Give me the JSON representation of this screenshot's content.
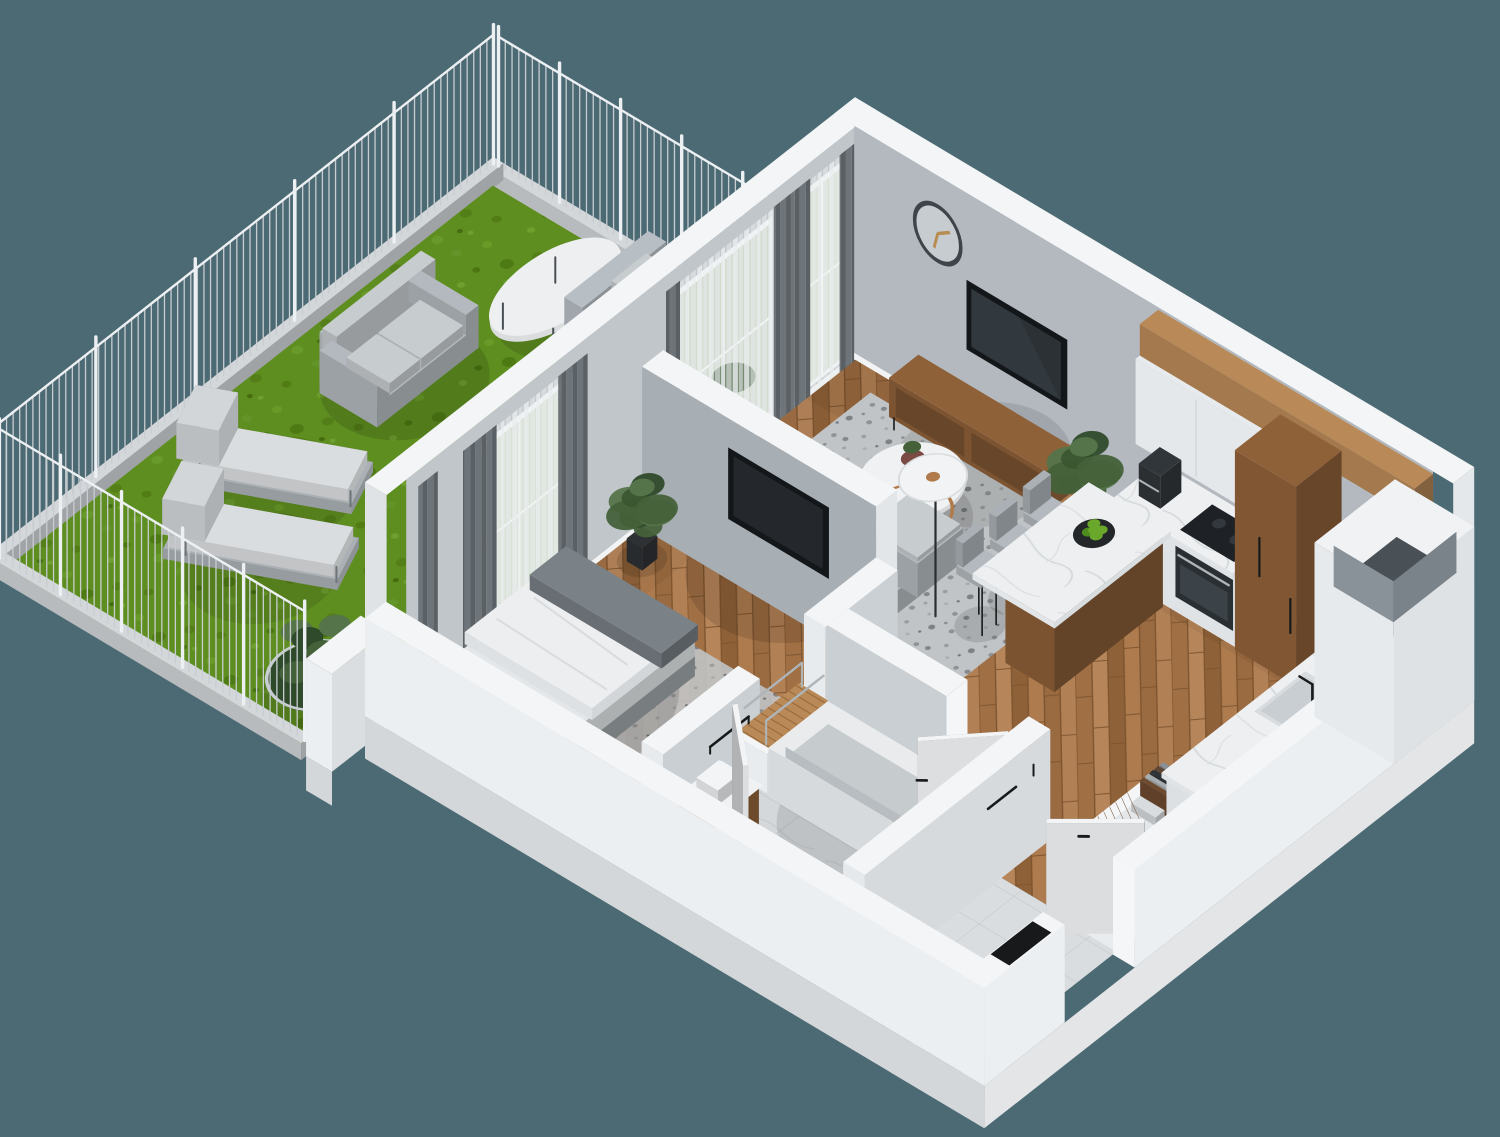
{
  "scene": {
    "label": "3D isometric floor plan rendering of a one-bedroom apartment with a fenced garden terrace",
    "type": "architectural-3d-floorplan-render",
    "background": "#4C6A74"
  },
  "palette": {
    "bg": "#4C6A74",
    "wallTop": "#F3F5F6",
    "wallExt": "#ECEFF1",
    "wallExtShade": "#D9DEE1",
    "wallNW": "#C0C6CA",
    "wallNE": "#B3B9BF",
    "wallDivider": "#A8AFB4",
    "bathWall": "#C9CFD3",
    "entryWallFace": "#D6DADD",
    "woodFloor": "#A9774B",
    "woodFurn": "#8F6139",
    "woodLight": "#B98A58",
    "grass": "#5E8E20",
    "fenceBar": "#C8CDD1",
    "fencePost": "#EDF0F2",
    "curb": "#D3D7DA",
    "rug": "#C1C4C6",
    "sofa": "#B3B9BE",
    "cushion": "#C7CCCF",
    "bedWhite": "#ECEEF0",
    "throwGray": "#7A8187",
    "marble": "#EDEFF1",
    "counterWhite": "#E8EBED",
    "bathFloor": "#D4D8DB",
    "tile": "#E4E7E9",
    "entryTile": "#D9DDDF",
    "tvDark": "#14171A",
    "screen": "#2B3134",
    "black": "#17191B",
    "steel": "#AEB5BA",
    "copper": "#B17A4A",
    "apple": "#69A82B",
    "plant": "#44613A",
    "plantDark": "#2F4A2B",
    "pot": "#2E3134",
    "curtain": "#6E757A",
    "sheer": "#EAEDEF",
    "door": "#F2F4F5",
    "clockRim": "#3E444A",
    "clockHand": "#B78C50",
    "glazing": "#D7E1D3"
  },
  "garden_terrace": {
    "floor": "grass-lawn",
    "enclosure": "metal-picket-fence-on-concrete-curb",
    "furniture": [
      "outdoor-two-seat-sofa",
      "oval-marble-coffee-table",
      "daybed-chaise",
      "sun-lounger",
      "sun-lounger",
      "round-wire-planter",
      "wicker-lantern"
    ]
  },
  "living_room": {
    "floor": "herringbone-wood",
    "items": [
      "wall-clock",
      "tv-wall-niche",
      "media-console",
      "potted-plant",
      "area-rug",
      "round-coffee-table",
      "flower-vase",
      "floor-lamp",
      "corner-sofa",
      "glass-door-to-garden",
      "curtains"
    ]
  },
  "kitchen": {
    "floor": "herringbone-wood",
    "items": [
      "upper-cabinets",
      "wood-panel-band",
      "cooker-hood",
      "induction-hob",
      "built-in-oven",
      "coffee-machine",
      "tall-wood-cabinet",
      "corner-duct-shaft",
      "bar-counter",
      "bar-stools",
      "fruit-bowl-green-apples",
      "sink-counter",
      "black-faucet",
      "open-shelf-with-books-and-records"
    ]
  },
  "bedroom": {
    "floor": "herringbone-wood",
    "items": [
      "double-bed",
      "pillows",
      "gray-throw-blanket",
      "bedside-rug",
      "window-to-garden",
      "curtains",
      "potted-plant",
      "tv-niche-in-divider-wall",
      "slatted-bench-niche"
    ]
  },
  "bathroom": {
    "floor": "marble-tile",
    "items": [
      "bathtub",
      "wood-vanity-with-basin",
      "walk-in-shower",
      "towel-bar",
      "white-door-ajar"
    ]
  },
  "hallway_entry": {
    "floor": "stone-tile",
    "items": [
      "entrance-door-ajar",
      "black-doormat",
      "wall-hooks"
    ]
  }
}
